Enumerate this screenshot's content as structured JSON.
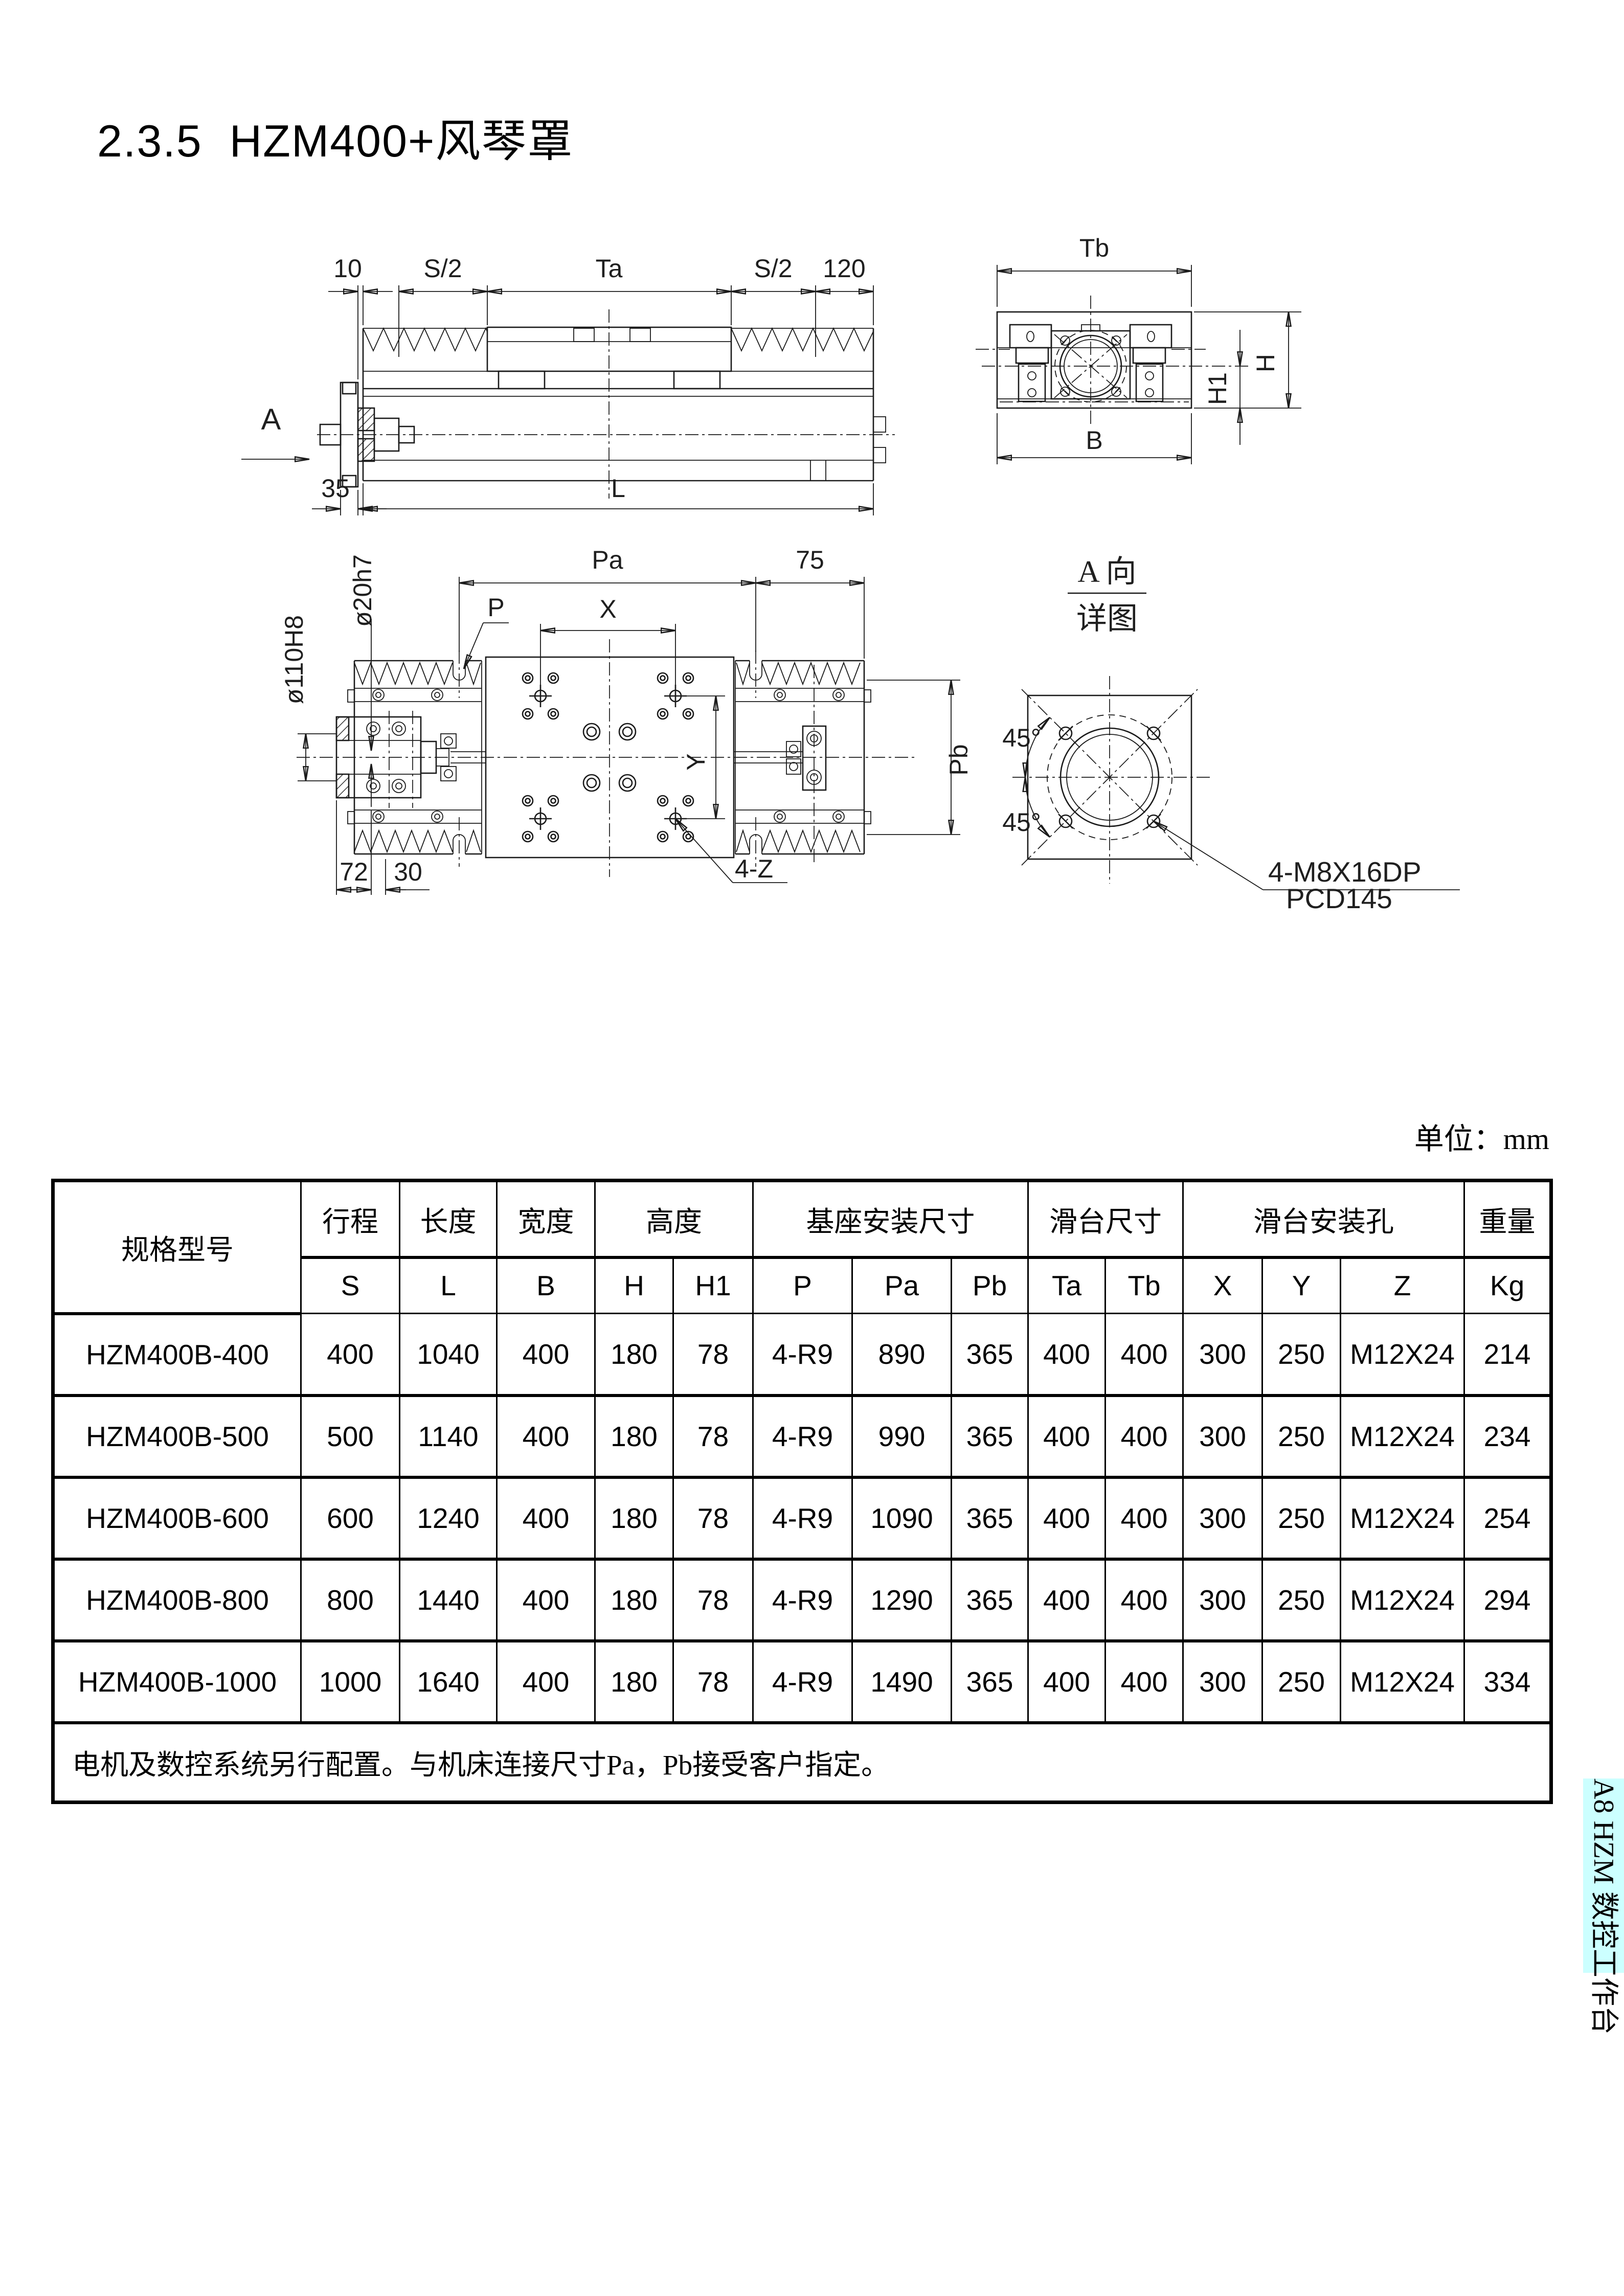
{
  "page": {
    "title": "2.3.5  HZM400+风琴罩"
  },
  "unit_label": "单位：mm",
  "side_tab": {
    "label": "A8 HZM 数控工作台",
    "bg": "#ccffff"
  },
  "drawings": {
    "side_view": {
      "dim_10": "10",
      "dim_s2_left": "S/2",
      "dim_ta": "Ta",
      "dim_s2_right": "S/2",
      "dim_120": "120",
      "dim_35": "35",
      "dim_l": "L",
      "view_label": "A"
    },
    "end_view": {
      "dim_tb": "Tb",
      "dim_h": "H",
      "dim_h1": "H1",
      "dim_b": "B"
    },
    "plan_view": {
      "dim_pa": "Pa",
      "dim_75": "75",
      "dim_p": "P",
      "dim_x": "X",
      "dim_y": "Y",
      "dim_pb": "Pb",
      "dim_dia20": "ø20h7",
      "dim_dia110": "ø110H8",
      "dim_72": "72",
      "dim_30": "30",
      "dim_4z": "4-Z"
    },
    "detail_view": {
      "title_line1": "A 向",
      "title_line2": "详图",
      "angle_upper": "45°",
      "angle_lower": "45°",
      "note_line1": "4-M8X16DP",
      "note_line2": "PCD145"
    }
  },
  "table": {
    "model_header": "规格型号",
    "group_headers": {
      "stroke": "行程",
      "length": "长度",
      "width": "宽度",
      "height": "高度",
      "base_mount": "基座安装尺寸",
      "slide_size": "滑台尺寸",
      "slide_holes": "滑台安装孔",
      "weight": "重量"
    },
    "sub_headers": [
      "S",
      "L",
      "B",
      "H",
      "H1",
      "P",
      "Pa",
      "Pb",
      "Ta",
      "Tb",
      "X",
      "Y",
      "Z",
      "Kg"
    ],
    "rows": [
      [
        "HZM400B-400",
        "400",
        "1040",
        "400",
        "180",
        "78",
        "4-R9",
        "890",
        "365",
        "400",
        "400",
        "300",
        "250",
        "M12X24",
        "214"
      ],
      [
        "HZM400B-500",
        "500",
        "1140",
        "400",
        "180",
        "78",
        "4-R9",
        "990",
        "365",
        "400",
        "400",
        "300",
        "250",
        "M12X24",
        "234"
      ],
      [
        "HZM400B-600",
        "600",
        "1240",
        "400",
        "180",
        "78",
        "4-R9",
        "1090",
        "365",
        "400",
        "400",
        "300",
        "250",
        "M12X24",
        "254"
      ],
      [
        "HZM400B-800",
        "800",
        "1440",
        "400",
        "180",
        "78",
        "4-R9",
        "1290",
        "365",
        "400",
        "400",
        "300",
        "250",
        "M12X24",
        "294"
      ],
      [
        "HZM400B-1000",
        "1000",
        "1640",
        "400",
        "180",
        "78",
        "4-R9",
        "1490",
        "365",
        "400",
        "400",
        "300",
        "250",
        "M12X24",
        "334"
      ]
    ],
    "note": "电机及数控系统另行配置。与机床连接尺寸Pa，Pb接受客户指定。"
  }
}
